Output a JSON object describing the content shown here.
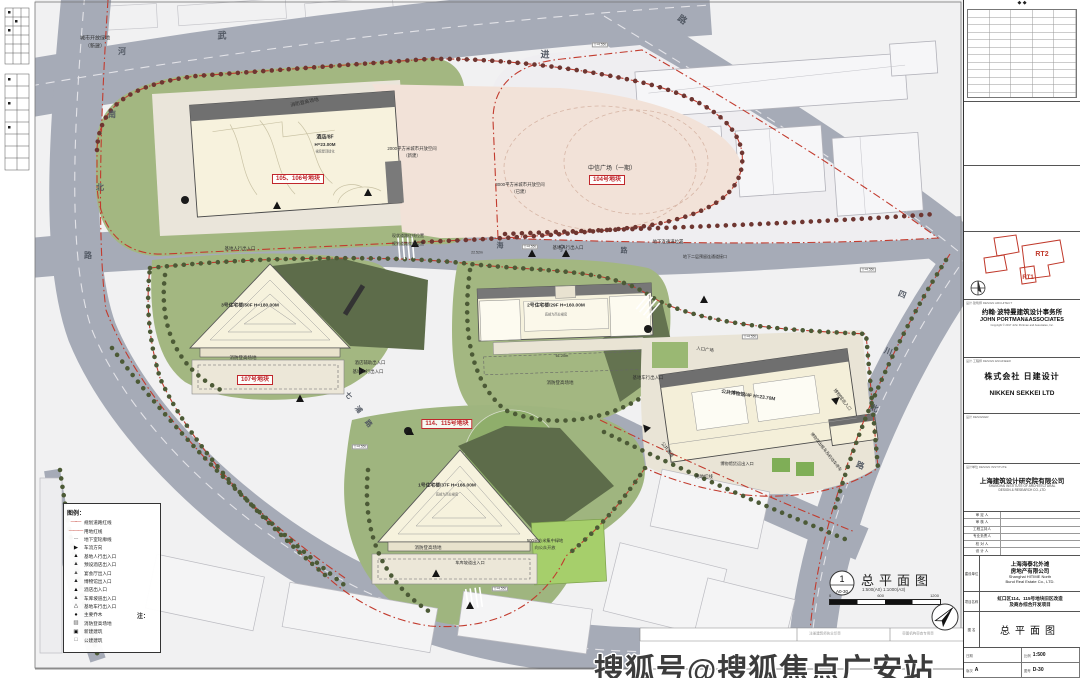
{
  "colors": {
    "road_gray": "#a6abb7",
    "paper": "#f1f1f2",
    "grass": "#a3b781",
    "building_cream": "#f7f2dd",
    "red_line": "#c23b2e",
    "pink_open_space": "#f2e2d8"
  },
  "watermark": "搜狐号@搜狐焦点广安站",
  "legend": {
    "title": "图例：",
    "items": [
      {
        "glyph": "—·—",
        "color": "#c23b2e",
        "label": "规划道路红线"
      },
      {
        "glyph": "———",
        "color": "#c23b2e",
        "label": "用地红线"
      },
      {
        "glyph": "- - -",
        "color": "#777777",
        "label": "地下室轮廓线"
      },
      {
        "glyph": "▶",
        "color": "#111111",
        "label": "车流方向"
      },
      {
        "glyph": "▲",
        "color": "#111111",
        "label": "基地人行出入口"
      },
      {
        "glyph": "▲",
        "color": "#333333",
        "label": "预设酒店出入口"
      },
      {
        "glyph": "▲",
        "color": "#555555",
        "label": "宴会厅出入口"
      },
      {
        "glyph": "▲",
        "color": "#222222",
        "label": "博物馆出入口"
      },
      {
        "glyph": "▲",
        "color": "#000000",
        "label": "酒店出入口"
      },
      {
        "glyph": "▲",
        "color": "#444444",
        "label": "车库坡道出入口"
      },
      {
        "glyph": "△",
        "color": "#111111",
        "label": "基地车行出入口"
      },
      {
        "glyph": "●",
        "color": "#111111",
        "label": "主要乔木"
      },
      {
        "glyph": "▨",
        "color": "#555555",
        "label": "消防登高场地"
      },
      {
        "glyph": "▣",
        "color": "#111111",
        "label": "新建建筑"
      },
      {
        "glyph": "□",
        "color": "#555555",
        "label": "公建建筑"
      }
    ]
  },
  "notes": {
    "title": "注：",
    "lines": [
      "1. 14034平方米的人防布置在105、106、107号地块的地下三层、地下四层",
      "2. 日照报告另附",
      "3. 消防车道与登高面信息详见消防分析图",
      "4. 图中所注尺寸均以米为单位，建筑尺寸、道路宽度均为完成面尺寸",
      "    退界尺寸为道路边线尺寸"
    ]
  },
  "sheet_title": {
    "num": "1",
    "sheet": "A0-30",
    "title": "总平面图",
    "scale": "1:500(A0)  1:1000(A3)",
    "bar": [
      "0",
      "600",
      "1200"
    ]
  },
  "titleblock": {
    "revision_marks": "◆      ◆",
    "keyplan": {
      "rt1": "RT1",
      "rt2": "RT2"
    },
    "architect": {
      "section": "设计·建筑师  DESIGN ARCHITECT",
      "name_zh": "约翰·波特曼建筑设计事务所",
      "name_en": "JOHN PORTMAN&ASSOCIATES",
      "lines": [
        "ARCHITECTS AND ENGINEERS",
        "303 PEACHTREE CENTER AVE. NE, SUITE 575",
        "ATLANTA, GEORGIA 30308 USA",
        "TEL: 404-614-5252  FAX: 404-614-5553",
        "SHANGHAI, CHINA",
        "TEL: 86-21-6279-8600  FAX: 86-21-6279-8606"
      ],
      "copyright": "Copyright © 2017 John Portman and Associates, Inc."
    },
    "engineer": {
      "section": "设计·工程师  DESIGN ENGINEER",
      "name_zh": "株式会社 日建设计",
      "name_en": "NIKKEN SEKKEI LTD"
    },
    "designer_section": "设计  DESIGNER",
    "institute": {
      "section": "设计单位  DESIGN INSTITUTE",
      "name_zh": "上海建筑设计研究院有限公司",
      "name_en1": "SHANGHAI  INSTITUTE  OF  ARCHITECTURAL",
      "name_en2": "DESIGN  &  RESEARCH  CO.,LTD"
    },
    "roles": [
      "审 定 人",
      "审 核 人",
      "工程主持人",
      "专业负责人",
      "校 对 人",
      "设 计 人",
      "制 图 人"
    ],
    "client": {
      "section": "建设单位",
      "name_zh1": "上海海泰北外滩",
      "name_zh2": "房地产有限公司",
      "name_en1": "Shanghai HITIME North",
      "name_en2": "Bund Real Estate Co., LTD."
    },
    "project": {
      "section": "项目名称",
      "line1": "虹口区114、115号地块旧区改造",
      "line2": "及商办综合开发项目"
    },
    "drawing": {
      "section": "图 名",
      "title": "总平面图"
    },
    "bottom": {
      "date_label": "日期",
      "scale_label": "比例",
      "scale": "1:500",
      "rev_label": "版次",
      "rev": "A",
      "no_label": "图号",
      "no": "D-30"
    }
  },
  "plan": {
    "elevation_label": "▽+4.550",
    "elevation_marks": [
      {
        "x": 530,
        "y": 247
      },
      {
        "x": 600,
        "y": 45
      },
      {
        "x": 868,
        "y": 270
      },
      {
        "x": 360,
        "y": 447
      },
      {
        "x": 500,
        "y": 589
      },
      {
        "x": 750,
        "y": 337
      }
    ],
    "labels": [
      {
        "t": "武",
        "x": 222,
        "y": 36,
        "fs": 9,
        "cls": "road"
      },
      {
        "t": "进",
        "x": 545,
        "y": 55,
        "fs": 9,
        "cls": "road"
      },
      {
        "t": "路",
        "x": 682,
        "y": 20,
        "fs": 9,
        "rot": 35,
        "cls": "road"
      },
      {
        "t": "海",
        "x": 500,
        "y": 246,
        "fs": 7,
        "cls": "road"
      },
      {
        "t": "宁",
        "x": 562,
        "y": 249,
        "fs": 7,
        "cls": "road"
      },
      {
        "t": "路",
        "x": 624,
        "y": 251,
        "fs": 7,
        "cls": "road"
      },
      {
        "t": "河",
        "x": 122,
        "y": 52,
        "fs": 8,
        "cls": "road"
      },
      {
        "t": "南",
        "x": 112,
        "y": 115,
        "fs": 8,
        "cls": "road"
      },
      {
        "t": "北",
        "x": 100,
        "y": 188,
        "fs": 8,
        "cls": "road"
      },
      {
        "t": "路",
        "x": 88,
        "y": 256,
        "fs": 8,
        "cls": "road"
      },
      {
        "t": "四",
        "x": 902,
        "y": 295,
        "fs": 8,
        "rot": 22,
        "cls": "road"
      },
      {
        "t": "川",
        "x": 888,
        "y": 352,
        "fs": 8,
        "rot": 22,
        "cls": "road"
      },
      {
        "t": "北",
        "x": 874,
        "y": 409,
        "fs": 8,
        "rot": 22,
        "cls": "road"
      },
      {
        "t": "路",
        "x": 860,
        "y": 466,
        "fs": 8,
        "rot": 22,
        "cls": "road"
      },
      {
        "t": "七",
        "x": 348,
        "y": 396,
        "fs": 7,
        "rot": 52,
        "cls": "road"
      },
      {
        "t": "浦",
        "x": 358,
        "y": 410,
        "fs": 7,
        "rot": 52,
        "cls": "road"
      },
      {
        "t": "路",
        "x": 368,
        "y": 424,
        "fs": 7,
        "rot": 52,
        "cls": "road"
      },
      {
        "t": "城市开放绿地",
        "x": 95,
        "y": 39,
        "fs": 5
      },
      {
        "t": "（新建）",
        "x": 95,
        "y": 47,
        "fs": 5
      },
      {
        "t": "消防登高场地",
        "x": 305,
        "y": 104,
        "fs": 4.8,
        "rot": -12
      },
      {
        "t": "2000平方米城市开放空间",
        "x": 412,
        "y": 149,
        "fs": 4.4
      },
      {
        "t": "（新建）",
        "x": 412,
        "y": 156,
        "fs": 4.4
      },
      {
        "t": "3000平方米城市开放空间",
        "x": 520,
        "y": 185,
        "fs": 4.4
      },
      {
        "t": "（已建）",
        "x": 520,
        "y": 192,
        "fs": 4.4
      },
      {
        "t": "中信广场（一期）",
        "x": 612,
        "y": 169,
        "fs": 6
      },
      {
        "t": "基地人行出入口",
        "x": 568,
        "y": 248,
        "fs": 4.4
      },
      {
        "t": "基地人行出入口",
        "x": 240,
        "y": 249,
        "fs": 4.4
      },
      {
        "t": "基地人行出入口",
        "x": 368,
        "y": 372,
        "fs": 4.4
      },
      {
        "t": "酒店辅助出入口",
        "x": 370,
        "y": 363,
        "fs": 4.4
      },
      {
        "t": "地下连通道位置",
        "x": 668,
        "y": 242,
        "fs": 4.4
      },
      {
        "t": "地下二层预留连通道接口",
        "x": 705,
        "y": 257,
        "fs": 4
      },
      {
        "t": "现状道路红线位置",
        "x": 408,
        "y": 236,
        "fs": 4
      },
      {
        "t": "规划道路红线位置",
        "x": 408,
        "y": 244,
        "fs": 4
      },
      {
        "t": "消防登高场地",
        "x": 243,
        "y": 358,
        "fs": 4.5
      },
      {
        "t": "消防登高场地",
        "x": 560,
        "y": 383,
        "fs": 4.5
      },
      {
        "t": "消防登高场地",
        "x": 428,
        "y": 548,
        "fs": 4.5
      },
      {
        "t": "基地车行出入口",
        "x": 648,
        "y": 378,
        "fs": 4.4
      },
      {
        "t": "车库坡道出入口",
        "x": 470,
        "y": 563,
        "fs": 4.2
      },
      {
        "t": "入口广场",
        "x": 705,
        "y": 350,
        "fs": 4.4,
        "rot": 8
      },
      {
        "t": "博物馆出入口",
        "x": 842,
        "y": 400,
        "fs": 4.4,
        "rot": 52
      },
      {
        "t": "博物馆货运出入口",
        "x": 737,
        "y": 464,
        "fs": 4.2
      },
      {
        "t": "博物馆出租车及机动车停车",
        "x": 826,
        "y": 452,
        "fs": 4,
        "rot": 52
      },
      {
        "t": "公共通道",
        "x": 667,
        "y": 450,
        "fs": 4.4,
        "rot": 52
      },
      {
        "t": "用地红线",
        "x": 704,
        "y": 477,
        "fs": 4.4
      },
      {
        "t": "500平方米集中绿地",
        "x": 545,
        "y": 541,
        "fs": 4.2
      },
      {
        "t": "向公众开放",
        "x": 545,
        "y": 548,
        "fs": 4.2
      },
      {
        "t": "61.20m",
        "x": 562,
        "y": 357,
        "fs": 3.8
      },
      {
        "t": "22.52m",
        "x": 477,
        "y": 253,
        "fs": 3.5
      },
      {
        "t": "酒店/8F",
        "x": 325,
        "y": 138,
        "fs": 5,
        "cls": "bld"
      },
      {
        "t": "H=23.00M",
        "x": 325,
        "y": 145,
        "fs": 4.5,
        "cls": "bld"
      },
      {
        "t": "裙房屋顶绿化",
        "x": 325,
        "y": 152,
        "fs": 3.2,
        "cls": "smx"
      },
      {
        "t": "3号住宅楼/50F H=180.00M",
        "x": 250,
        "y": 307,
        "fs": 4.8,
        "cls": "bld"
      },
      {
        "t": "2号住宅楼/29F H=160.00M",
        "x": 556,
        "y": 307,
        "fs": 4.8,
        "cls": "bld"
      },
      {
        "t": "底部为商业裙房",
        "x": 556,
        "y": 315,
        "fs": 3.2,
        "cls": "smx"
      },
      {
        "t": "1号住宅楼/37F H=166.00M",
        "x": 447,
        "y": 487,
        "fs": 4.8,
        "cls": "bld"
      },
      {
        "t": "底部为商业裙房",
        "x": 447,
        "y": 495,
        "fs": 3.2,
        "cls": "smx"
      },
      {
        "t": "公共博物馆/4F H=23.70M",
        "x": 748,
        "y": 397,
        "fs": 4.8,
        "rot": 8,
        "cls": "bld"
      },
      {
        "t": "105、106号地块",
        "x": 298,
        "y": 179,
        "fs": 6,
        "cls": "redbox"
      },
      {
        "t": "104号地块",
        "x": 607,
        "y": 180,
        "fs": 6,
        "cls": "redbox"
      },
      {
        "t": "107号地块",
        "x": 255,
        "y": 380,
        "fs": 6,
        "cls": "redbox"
      },
      {
        "t": "114、115号地块",
        "x": 447,
        "y": 424,
        "fs": 6,
        "cls": "redbox"
      },
      {
        "t": "注册建筑师执业印章",
        "x": 825,
        "y": 634,
        "fs": 3.5,
        "cls": "stamp"
      },
      {
        "t": "审图机构审查专用章",
        "x": 918,
        "y": 634,
        "fs": 3.5,
        "cls": "stamp"
      }
    ]
  }
}
